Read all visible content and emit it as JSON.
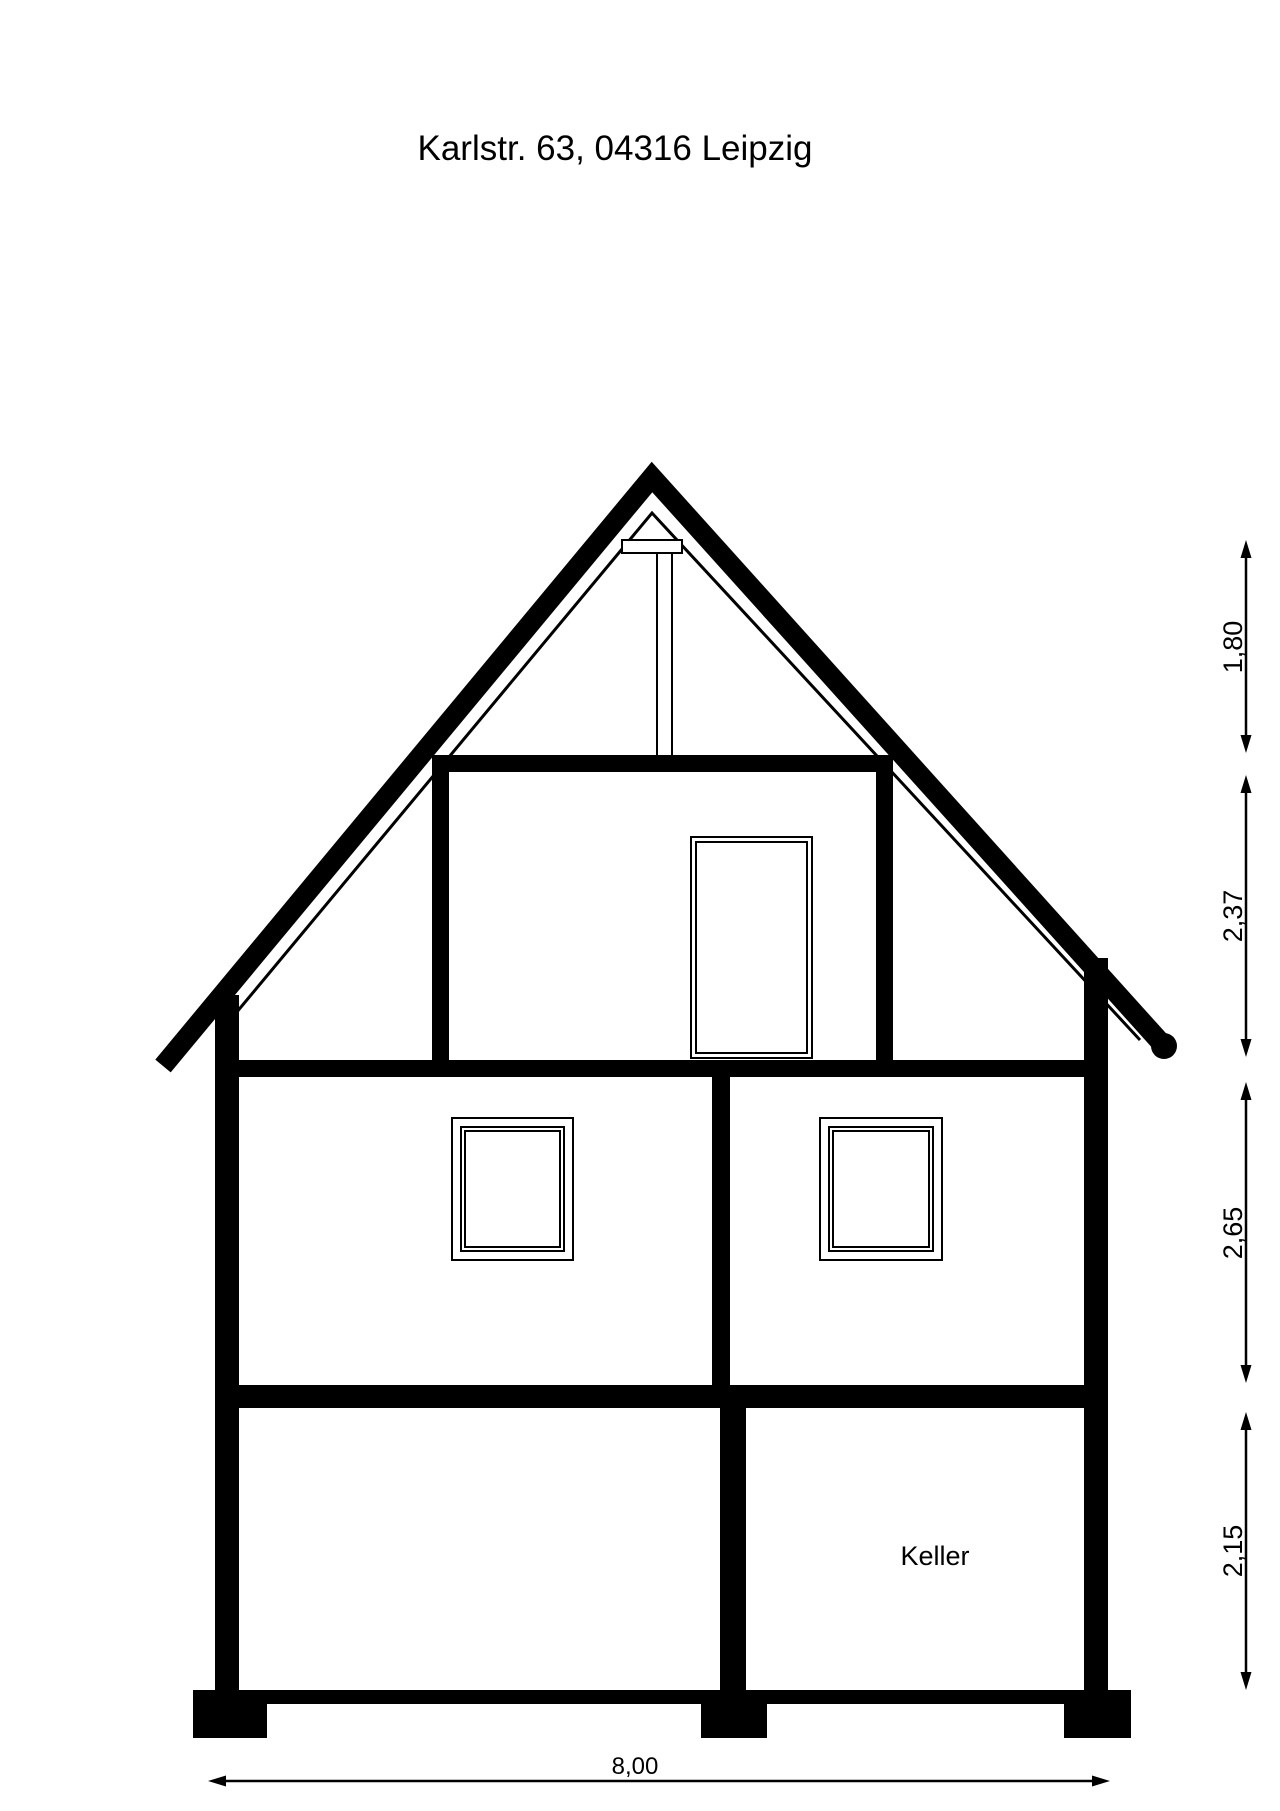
{
  "title": "Karlstr. 63, 04316 Leipzig",
  "plan": {
    "room_label": "Keller",
    "dim_right": [
      {
        "label": "1,80"
      },
      {
        "label": "2,37"
      },
      {
        "label": "2,65"
      },
      {
        "label": "2,15"
      }
    ],
    "dim_bottom": {
      "label": "8,00"
    }
  },
  "colors": {
    "ink": "#000000",
    "paper": "#ffffff"
  }
}
